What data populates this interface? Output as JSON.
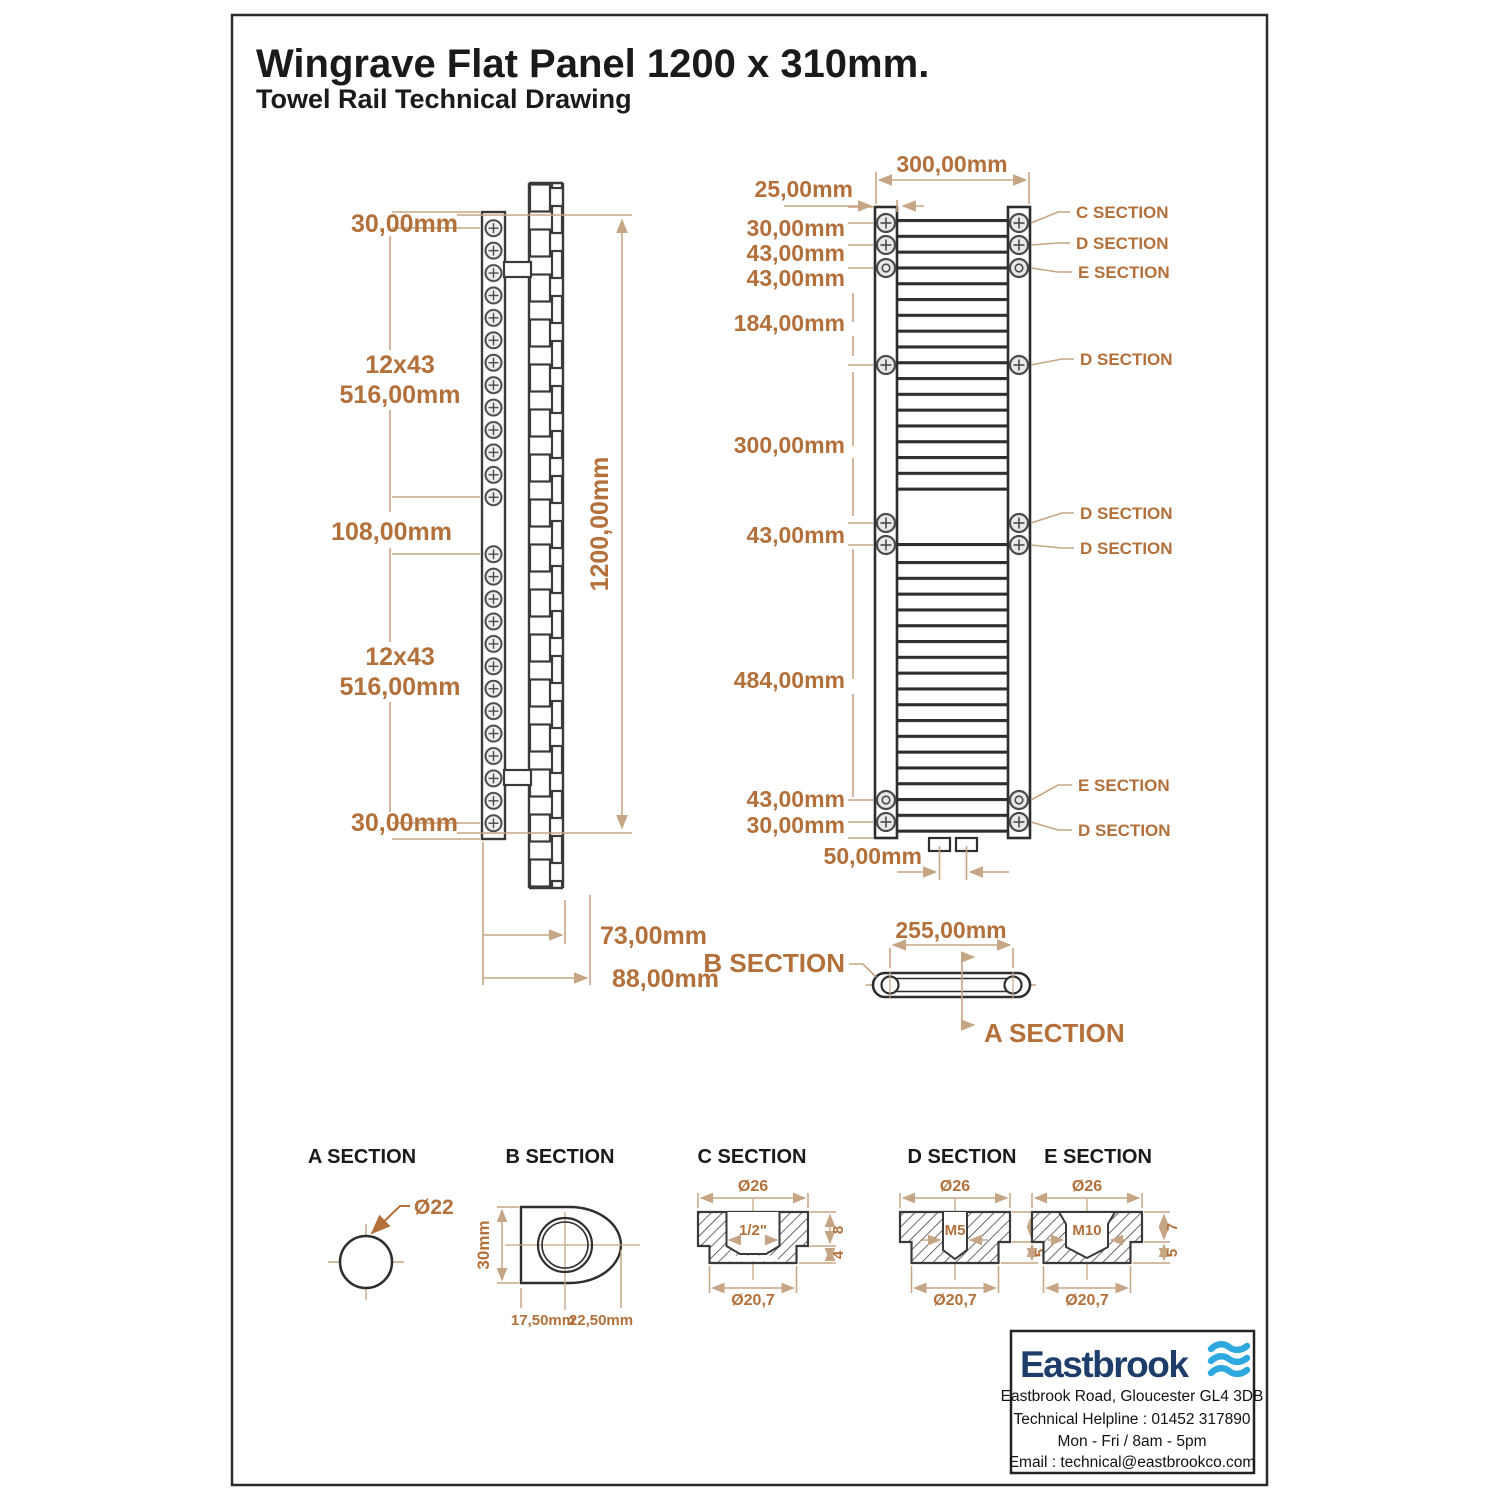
{
  "page": {
    "title": "Wingrave Flat Panel 1200 x 310mm.",
    "subtitle": "Towel Rail Technical Drawing"
  },
  "side_view": {
    "top_offset": "30,00mm",
    "group1_count": "12x43",
    "group1_length": "516,00mm",
    "mid_gap": "108,00mm",
    "group2_count": "12x43",
    "group2_length": "516,00mm",
    "bottom_offset": "30,00mm",
    "overall_height": "1200,00mm",
    "depth_to_rail": "73,00mm",
    "depth_overall": "88,00mm"
  },
  "front_view": {
    "overall_width": "300,00mm",
    "rung_inset": "25,00mm",
    "left_dims": [
      "30,00mm",
      "43,00mm",
      "43,00mm",
      "184,00mm",
      "300,00mm",
      "43,00mm",
      "484,00mm",
      "43,00mm",
      "30,00mm"
    ],
    "pipe_spacing": "50,00mm",
    "callouts": [
      "C SECTION",
      "D SECTION",
      "E SECTION",
      "D SECTION",
      "D SECTION",
      "D SECTION",
      "E SECTION",
      "D SECTION"
    ]
  },
  "plan_view": {
    "width": "255,00mm",
    "b_label": "B SECTION",
    "a_label": "A SECTION"
  },
  "sections": {
    "a": {
      "title": "A SECTION",
      "diameter": "Ø22"
    },
    "b": {
      "title": "B SECTION",
      "height": "30mm",
      "offset_left": "17,50mm",
      "offset_right": "22,50mm"
    },
    "c": {
      "title": "C SECTION",
      "outer": "Ø26",
      "thread": "1/2\"",
      "depth1": "8",
      "depth2": "4",
      "inner": "Ø20,7"
    },
    "d": {
      "title": "D SECTION",
      "outer": "Ø26",
      "thread": "M5",
      "depth1": "7",
      "depth2": "5",
      "inner": "Ø20,7"
    },
    "e": {
      "title": "E SECTION",
      "outer": "Ø26",
      "thread": "M10",
      "depth1": "7",
      "depth2": "5",
      "inner": "Ø20,7"
    }
  },
  "logo_box": {
    "brand": "Eastbrook",
    "address": "Eastbrook Road, Gloucester GL4 3DB",
    "helpline": "Technical Helpline : 01452 317890",
    "hours": "Mon - Fri / 8am - 5pm",
    "email": "Email : technical@eastbrookco.com"
  },
  "colors": {
    "dim_text": "#b3703a",
    "dim_line": "#c6a584",
    "outline": "#3a3a3a",
    "logo_navy": "#1d3d6b",
    "logo_blue": "#2ea9e0"
  }
}
